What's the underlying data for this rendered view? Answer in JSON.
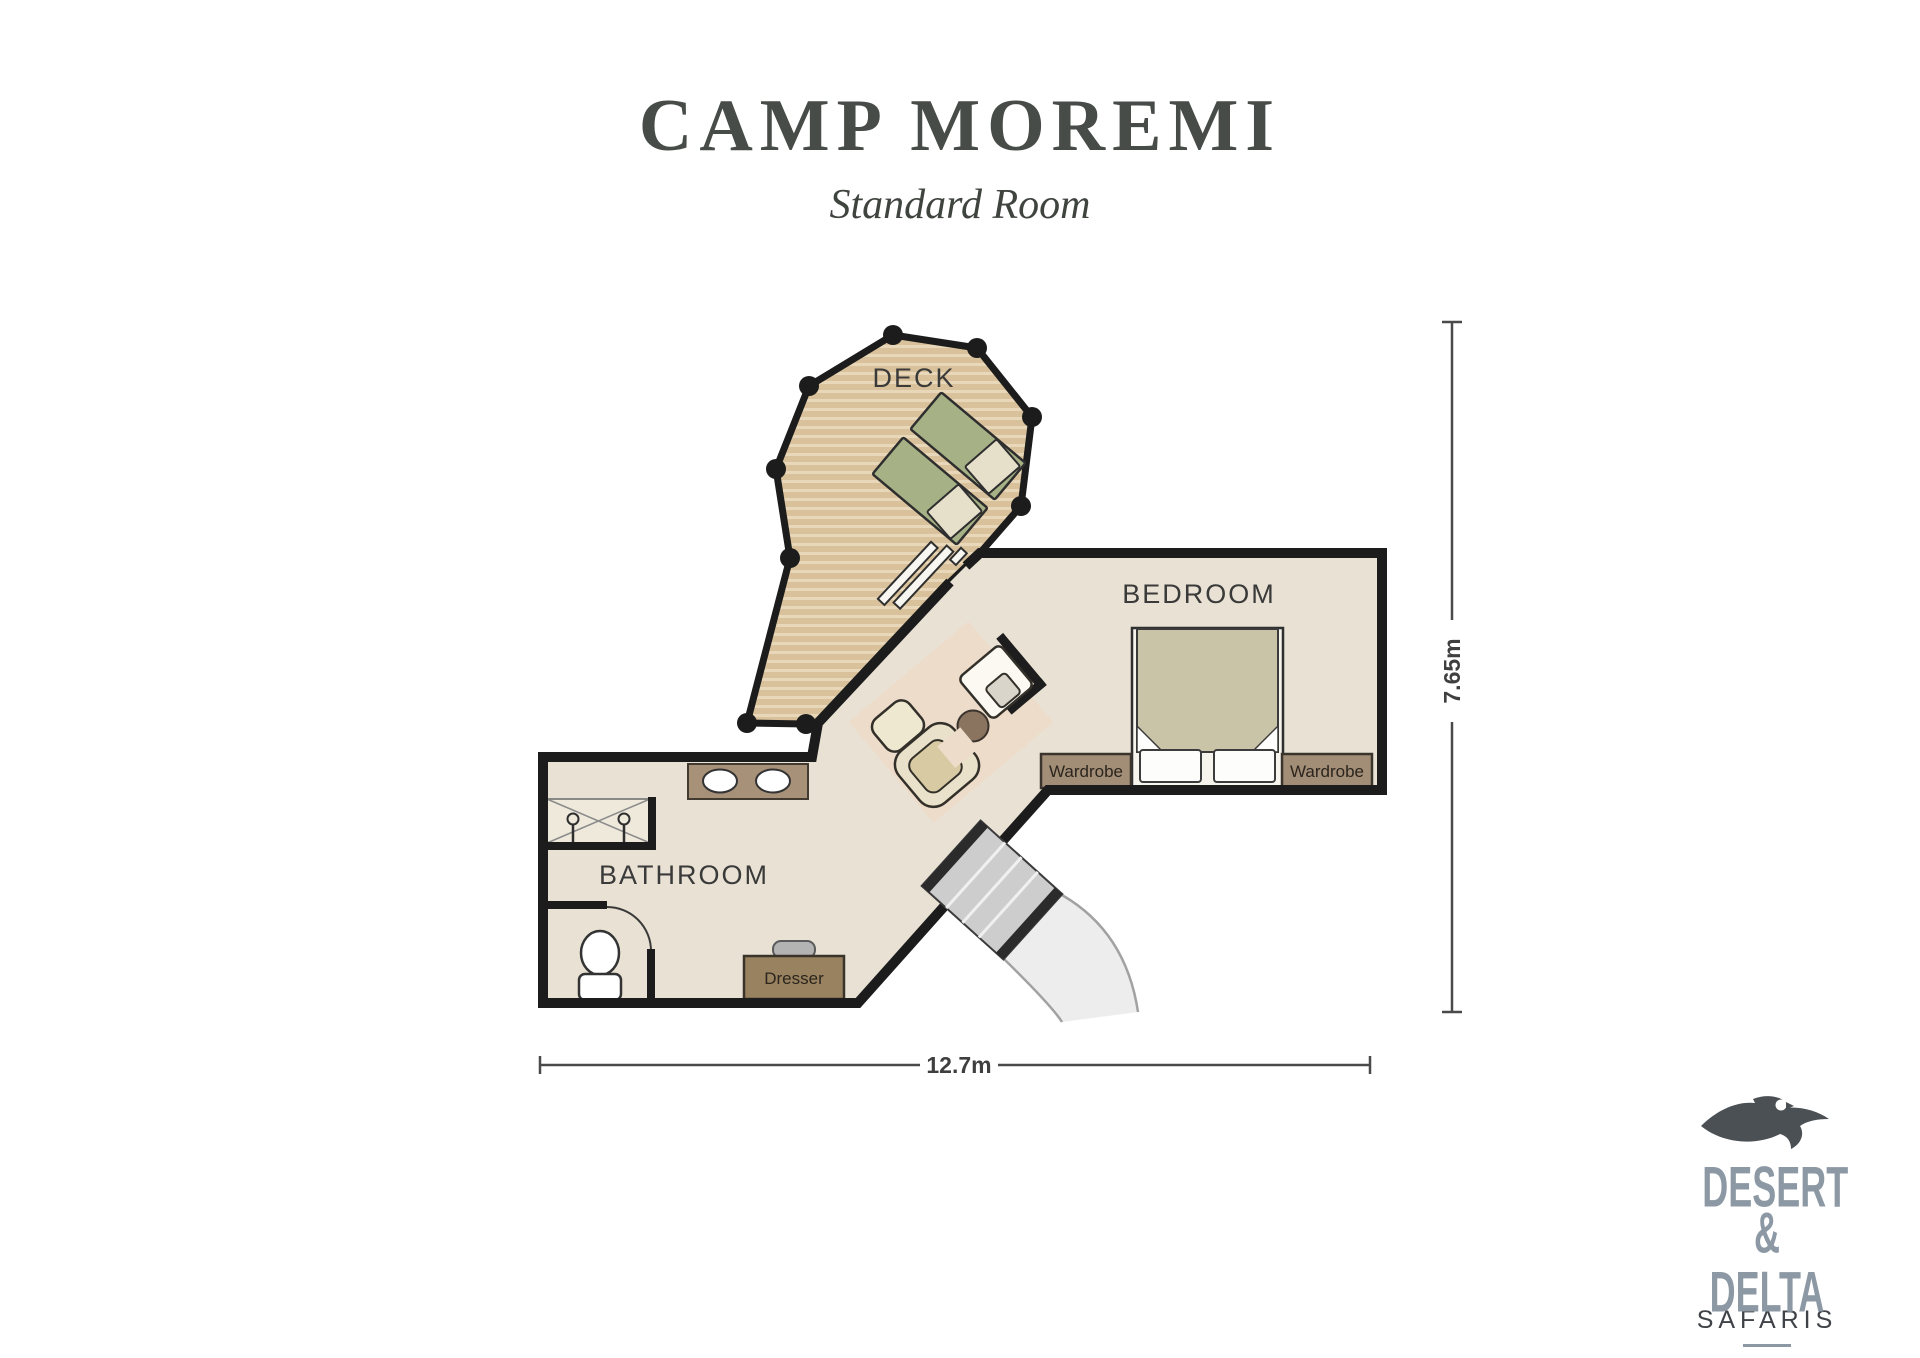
{
  "header": {
    "title": "CAMP MOREMI",
    "subtitle": "Standard Room"
  },
  "plan": {
    "room_labels": {
      "deck": "DECK",
      "bedroom": "BEDROOM",
      "bathroom": "BATHROOM"
    },
    "furniture_labels": {
      "wardrobe": "Wardrobe",
      "dresser": "Dresser"
    },
    "dimensions": {
      "height": "7.65m",
      "width": "12.7m"
    },
    "colors": {
      "wall": "#1c1c1c",
      "deck": "#d9c29b",
      "deck_stripe": "#e8d7b8",
      "floor": "#e9e2d4",
      "rug": "#eddcca",
      "lounger_green": "#a6b186",
      "wood_trim": "#a28d77",
      "logo_accent": "#8c99a5"
    }
  },
  "logo": {
    "line1": "DESERT",
    "line2": "& DELTA",
    "line3": "SAFARIS"
  }
}
